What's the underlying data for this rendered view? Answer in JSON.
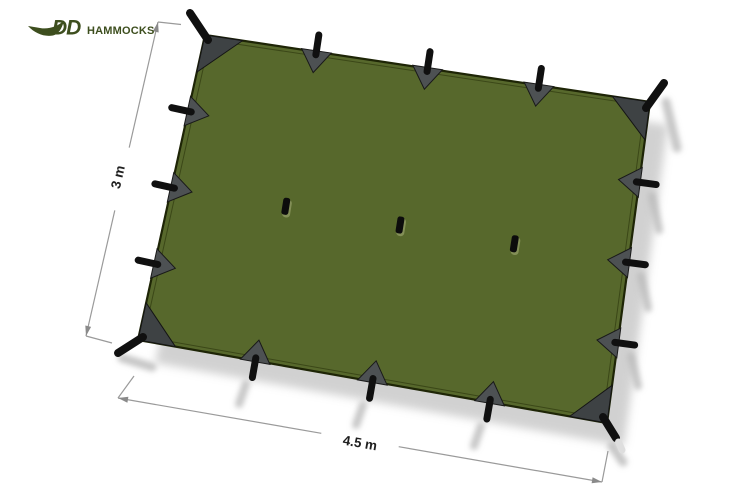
{
  "logo": {
    "dd": "DD",
    "hammocks": "HAMMOCKS"
  },
  "diagram": {
    "product": "tarp top view with dimensions",
    "height_label": "3 m",
    "width_label": "4.5 m"
  },
  "colors": {
    "background": "#ffffff",
    "tarp_green": "#57682c",
    "tarp_outline": "#1e2506",
    "corner_patch_gray": "#3e4244",
    "edge_patch_gray": "#4d5153",
    "strap_black": "#101010",
    "logo_green": "#3d4e1e",
    "shadow_gray": "#c6c6c6",
    "dimension_line_gray": "#9a9a9a",
    "label_text": "#1f1f1f"
  }
}
